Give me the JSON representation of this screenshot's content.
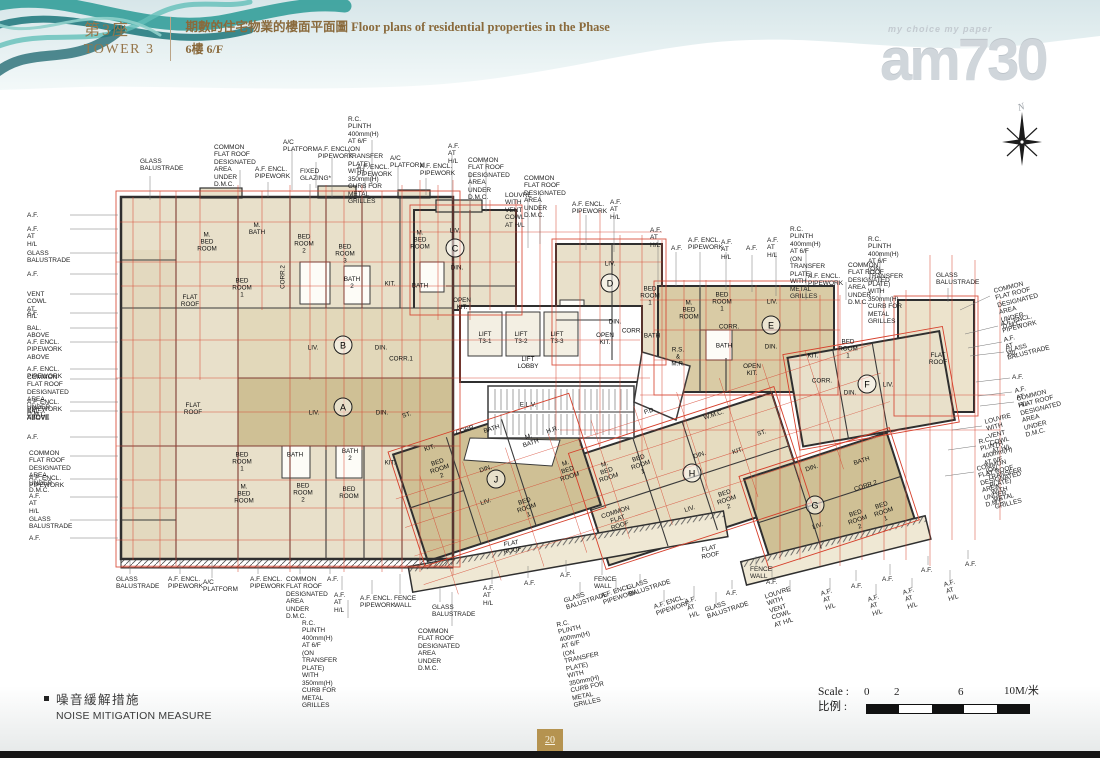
{
  "header": {
    "tower_zh": "第3座",
    "tower_en": "TOWER 3",
    "title_line1": "期數的住宅物業的樓面平面圖 Floor plans of residential properties in the Phase",
    "title_line2": "6樓 6/F"
  },
  "logo": {
    "tagline": "my choice my paper",
    "name": "am730"
  },
  "compass": {
    "label": "N"
  },
  "legend": {
    "zh": "噪音緩解措施",
    "en": "NOISE MITIGATION MEASURE"
  },
  "scale": {
    "label_en": "Scale : ",
    "label_zh": "比例 : ",
    "ticks": [
      "0",
      "2",
      "6",
      "10M/米"
    ]
  },
  "page_number": "20",
  "colors": {
    "accent_gold": "#96764a",
    "plan_red": "#d6402c",
    "beige": "#e8e0ca",
    "tan": "#cfc095",
    "teal": "#2a9a95"
  },
  "plan": {
    "units": [
      {
        "t": "A",
        "x": 343,
        "y": 407
      },
      {
        "t": "B",
        "x": 343,
        "y": 345
      },
      {
        "t": "C",
        "x": 455,
        "y": 248
      },
      {
        "t": "D",
        "x": 610,
        "y": 283
      },
      {
        "t": "E",
        "x": 771,
        "y": 325
      },
      {
        "t": "F",
        "x": 867,
        "y": 384
      },
      {
        "t": "G",
        "x": 815,
        "y": 505
      },
      {
        "t": "H",
        "x": 692,
        "y": 473
      },
      {
        "t": "J",
        "x": 496,
        "y": 479
      }
    ],
    "rooms": [
      {
        "t": "M. BED\nROOM",
        "x": 207,
        "y": 243
      },
      {
        "t": "M. BATH",
        "x": 257,
        "y": 230
      },
      {
        "t": "BED\nROOM 1",
        "x": 242,
        "y": 289
      },
      {
        "t": "BED\nROOM 2",
        "x": 304,
        "y": 245
      },
      {
        "t": "BED\nROOM 3",
        "x": 345,
        "y": 255
      },
      {
        "t": "BATH 2",
        "x": 352,
        "y": 284
      },
      {
        "t": "CORR.2",
        "x": 284,
        "y": 277,
        "rot": -90
      },
      {
        "t": "KIT.",
        "x": 390,
        "y": 285
      },
      {
        "t": "BATH",
        "x": 420,
        "y": 287
      },
      {
        "t": "FLAT ROOF",
        "x": 190,
        "y": 302
      },
      {
        "t": "LIV.",
        "x": 313,
        "y": 349
      },
      {
        "t": "DIN.",
        "x": 381,
        "y": 349
      },
      {
        "t": "CORR.1",
        "x": 401,
        "y": 360
      },
      {
        "t": "FLAT ROOF",
        "x": 193,
        "y": 410
      },
      {
        "t": "LIV.",
        "x": 314,
        "y": 414
      },
      {
        "t": "DIN.",
        "x": 382,
        "y": 414
      },
      {
        "t": "BED\nROOM 1",
        "x": 242,
        "y": 463
      },
      {
        "t": "BATH",
        "x": 295,
        "y": 456
      },
      {
        "t": "BATH 2",
        "x": 350,
        "y": 456
      },
      {
        "t": "KIT.",
        "x": 390,
        "y": 464
      },
      {
        "t": "M. BED\nROOM",
        "x": 244,
        "y": 495
      },
      {
        "t": "BED\nROOM 2",
        "x": 303,
        "y": 494
      },
      {
        "t": "BED\nROOM",
        "x": 349,
        "y": 494
      },
      {
        "t": "M. BED\nROOM",
        "x": 420,
        "y": 241
      },
      {
        "t": "LIV.",
        "x": 455,
        "y": 232
      },
      {
        "t": "DIN.",
        "x": 457,
        "y": 269
      },
      {
        "t": "OPEN KIT.",
        "x": 462,
        "y": 305
      },
      {
        "t": "LIFT\nT3-1",
        "x": 485,
        "y": 339
      },
      {
        "t": "LIFT\nT3-2",
        "x": 521,
        "y": 339
      },
      {
        "t": "LIFT\nT3-3",
        "x": 557,
        "y": 339
      },
      {
        "t": "LIFT LOBBY",
        "x": 528,
        "y": 364
      },
      {
        "t": "LIV.",
        "x": 610,
        "y": 265
      },
      {
        "t": "DIN.",
        "x": 615,
        "y": 323
      },
      {
        "t": "OPEN KIT.",
        "x": 605,
        "y": 340
      },
      {
        "t": "CORR.",
        "x": 632,
        "y": 332
      },
      {
        "t": "BED\nROOM 1",
        "x": 650,
        "y": 297
      },
      {
        "t": "BATH",
        "x": 652,
        "y": 337
      },
      {
        "t": "M. BED\nROOM",
        "x": 689,
        "y": 311
      },
      {
        "t": "BED\nROOM 1",
        "x": 722,
        "y": 303
      },
      {
        "t": "LIV.",
        "x": 772,
        "y": 303
      },
      {
        "t": "CORR.",
        "x": 729,
        "y": 328
      },
      {
        "t": "BATH",
        "x": 724,
        "y": 347
      },
      {
        "t": "DIN.",
        "x": 771,
        "y": 348
      },
      {
        "t": "OPEN KIT.",
        "x": 752,
        "y": 371
      },
      {
        "t": "KIT.",
        "x": 813,
        "y": 357
      },
      {
        "t": "BED\nROOM 1",
        "x": 848,
        "y": 350
      },
      {
        "t": "CORR.",
        "x": 822,
        "y": 382
      },
      {
        "t": "DIN.",
        "x": 850,
        "y": 394
      },
      {
        "t": "LIV.",
        "x": 888,
        "y": 386
      },
      {
        "t": "FLAT ROOF",
        "x": 938,
        "y": 360
      },
      {
        "t": "ST.",
        "x": 407,
        "y": 416,
        "rot": -18
      },
      {
        "t": "KIT.",
        "x": 430,
        "y": 449,
        "rot": -18
      },
      {
        "t": "BED\nROOM 2",
        "x": 440,
        "y": 470,
        "rot": -18
      },
      {
        "t": "CORR.",
        "x": 466,
        "y": 431,
        "rot": -18
      },
      {
        "t": "BATH",
        "x": 492,
        "y": 430,
        "rot": -18
      },
      {
        "t": "M. BATH",
        "x": 530,
        "y": 441,
        "rot": -18
      },
      {
        "t": "DIN.",
        "x": 486,
        "y": 470,
        "rot": -18
      },
      {
        "t": "LIV.",
        "x": 486,
        "y": 503,
        "rot": -18
      },
      {
        "t": "BED\nROOM 1",
        "x": 527,
        "y": 509,
        "rot": -18
      },
      {
        "t": "M. BED\nROOM",
        "x": 568,
        "y": 471,
        "rot": -18
      },
      {
        "t": "E.L.V.",
        "x": 528,
        "y": 406
      },
      {
        "t": "H.R.",
        "x": 553,
        "y": 431,
        "rot": -18
      },
      {
        "t": "P.D.",
        "x": 650,
        "y": 412,
        "rot": -18
      },
      {
        "t": "W.M.C.",
        "x": 714,
        "y": 416,
        "rot": -18
      },
      {
        "t": "R.S. & M.R.",
        "x": 678,
        "y": 358
      },
      {
        "t": "M. BED\nROOM",
        "x": 607,
        "y": 472,
        "rot": -18
      },
      {
        "t": "BED\nROOM 1",
        "x": 641,
        "y": 466,
        "rot": -18
      },
      {
        "t": "DIN.",
        "x": 700,
        "y": 456,
        "rot": -18
      },
      {
        "t": "KIT.",
        "x": 738,
        "y": 452,
        "rot": -18
      },
      {
        "t": "ST.",
        "x": 762,
        "y": 434,
        "rot": -18
      },
      {
        "t": "LIV.",
        "x": 690,
        "y": 510,
        "rot": -18
      },
      {
        "t": "BED\nROOM 2",
        "x": 727,
        "y": 501,
        "rot": -18
      },
      {
        "t": "COMMON\nFLAT ROOF",
        "x": 618,
        "y": 520,
        "rot": -18
      },
      {
        "t": "FLAT ROOF",
        "x": 710,
        "y": 553,
        "rot": -12
      },
      {
        "t": "FLAT ROOF",
        "x": 512,
        "y": 548,
        "rot": -10
      },
      {
        "t": "DIN.",
        "x": 812,
        "y": 469,
        "rot": -18
      },
      {
        "t": "BATH",
        "x": 862,
        "y": 462,
        "rot": -18
      },
      {
        "t": "CORR.2",
        "x": 866,
        "y": 487,
        "rot": -18
      },
      {
        "t": "LIV.",
        "x": 818,
        "y": 527,
        "rot": -18
      },
      {
        "t": "BED\nROOM 2",
        "x": 858,
        "y": 521,
        "rot": -18
      },
      {
        "t": "BED\nROOM 1",
        "x": 884,
        "y": 513,
        "rot": -18
      }
    ],
    "callouts": [
      {
        "t": "GLASS\nBALUSTRADE",
        "x": 140,
        "y": 158
      },
      {
        "t": "COMMON FLAT ROOF\nDESIGNATED AREA UNDER D.M.C.",
        "x": 214,
        "y": 144
      },
      {
        "t": "A.F. ENCL.\nPIPEWORK",
        "x": 255,
        "y": 166
      },
      {
        "t": "A/C PLATFORM",
        "x": 283,
        "y": 139
      },
      {
        "t": "A.F. ENCL.\nPIPEWORK",
        "x": 318,
        "y": 146
      },
      {
        "t": "FIXED\nGLAZING*",
        "x": 300,
        "y": 168
      },
      {
        "t": "R.C. PLINTH 400mm(H) AT 6/F\n(ON TRANSFER PLATE) WITH\n350mm(H) CURB FOR METAL GRILLES",
        "x": 348,
        "y": 116
      },
      {
        "t": "A.F. ENCL.\nPIPEWORK",
        "x": 357,
        "y": 164
      },
      {
        "t": "A/C PLATFORM",
        "x": 390,
        "y": 155
      },
      {
        "t": "A.F. ENCL.\nPIPEWORK",
        "x": 420,
        "y": 163
      },
      {
        "t": "A.F.\nAT H/L",
        "x": 448,
        "y": 143
      },
      {
        "t": "COMMON FLAT ROOF\nDESIGNATED AREA UNDER D.M.C.",
        "x": 468,
        "y": 157
      },
      {
        "t": "COMMON FLAT ROOF\nDESIGNATED AREA UNDER D.M.C.",
        "x": 524,
        "y": 175
      },
      {
        "t": "LOUVRE WITH\nVENT COWL\nAT H/L",
        "x": 505,
        "y": 192
      },
      {
        "t": "A.F. ENCL.\nPIPEWORK",
        "x": 572,
        "y": 201
      },
      {
        "t": "A.F.\nAT H/L",
        "x": 610,
        "y": 199
      },
      {
        "t": "A.F.\nAT H/L",
        "x": 650,
        "y": 227
      },
      {
        "t": "A.F.",
        "x": 671,
        "y": 245
      },
      {
        "t": "A.F. ENCL.\nPIPEWORK",
        "x": 688,
        "y": 237
      },
      {
        "t": "A.F.\nAT H/L",
        "x": 721,
        "y": 239
      },
      {
        "t": "A.F.",
        "x": 746,
        "y": 245
      },
      {
        "t": "A.F.\nAT H/L",
        "x": 767,
        "y": 237
      },
      {
        "t": "R.C. PLINTH 400mm(H) AT 6/F\n(ON TRANSFER PLATE)\nWITH METAL GRILLES",
        "x": 790,
        "y": 226
      },
      {
        "t": "R.C. PLINTH 400mm(H) AT 6/F\n(ON TRANSFER PLATE) WITH\n350mm(H) CURB FOR METAL GRILLES",
        "x": 868,
        "y": 236
      },
      {
        "t": "A.F. ENCL.\nPIPEWORK",
        "x": 808,
        "y": 273
      },
      {
        "t": "COMMON FLAT ROOF\nDESIGNATED AREA\nUNDER D.M.C.",
        "x": 848,
        "y": 262
      },
      {
        "t": "GLASS\nBALUSTRADE",
        "x": 936,
        "y": 272
      },
      {
        "t": "COMMON FLAT ROOF\nDESIGNATED AREA UNDER\nD.M.C.",
        "x": 993,
        "y": 288,
        "rot": -14
      },
      {
        "t": "A.F. ENCL. PIPEWORK",
        "x": 1000,
        "y": 321,
        "rot": -14
      },
      {
        "t": "A.F. AT H/L",
        "x": 1003,
        "y": 337,
        "rot": -14
      },
      {
        "t": "GLASS BALUSTRADE",
        "x": 1005,
        "y": 348,
        "rot": -14
      },
      {
        "t": "A.F.",
        "x": 1012,
        "y": 374
      },
      {
        "t": "A.F. AT H/L",
        "x": 1014,
        "y": 388,
        "rot": -14
      },
      {
        "t": "COMMON FLAT ROOF\nDESIGNATED AREA UNDER\nD.M.C.",
        "x": 1016,
        "y": 396,
        "rot": -14
      },
      {
        "t": "LOUVRE WITH\nVENT COWL AT H/L",
        "x": 984,
        "y": 419,
        "rot": -14
      },
      {
        "t": "R.C. PLINTH 400mm(H) AT 6/F\n(ON TRANSFER PLATE)\nWITH METAL GRILLES",
        "x": 978,
        "y": 439,
        "rot": -14
      },
      {
        "t": "COMMON FLAT ROOF\nDESIGNATED AREA\nUNDER D.M.C.",
        "x": 976,
        "y": 466,
        "rot": -14
      },
      {
        "t": "A.F.",
        "x": 27,
        "y": 212
      },
      {
        "t": "A.F. AT H/L",
        "x": 27,
        "y": 226
      },
      {
        "t": "GLASS BALUSTRADE",
        "x": 27,
        "y": 250
      },
      {
        "t": "A.F.",
        "x": 27,
        "y": 271
      },
      {
        "t": "VENT COWL AT H/L",
        "x": 27,
        "y": 291
      },
      {
        "t": "A.F.",
        "x": 27,
        "y": 310
      },
      {
        "t": "BAL. ABOVE",
        "x": 27,
        "y": 325
      },
      {
        "t": "A.F. ENCL. PIPEWORK ABOVE",
        "x": 27,
        "y": 339
      },
      {
        "t": "A.F. ENCL.  PIPEWORK",
        "x": 27,
        "y": 366
      },
      {
        "t": "COMMON FLAT ROOF\nDESIGNATED AREA UNDER D.M.C.",
        "x": 27,
        "y": 374
      },
      {
        "t": "A.F. ENCL. PIPEWORK ABOVE",
        "x": 27,
        "y": 399
      },
      {
        "t": "BAL. ABOVE",
        "x": 27,
        "y": 408
      },
      {
        "t": "A.F.",
        "x": 27,
        "y": 434
      },
      {
        "t": "COMMON FLAT ROOF\nDESIGNATED AREA UNDER D.M.C.",
        "x": 29,
        "y": 450
      },
      {
        "t": "A.F. ENCL.  PIPEWORK",
        "x": 29,
        "y": 475
      },
      {
        "t": "A.F.  AT H/L",
        "x": 29,
        "y": 493
      },
      {
        "t": "GLASS BALUSTRADE",
        "x": 29,
        "y": 516
      },
      {
        "t": "A.F.",
        "x": 29,
        "y": 535
      },
      {
        "t": "GLASS\nBALUSTRADE",
        "x": 116,
        "y": 576
      },
      {
        "t": "A.F. ENCL.\nPIPEWORK",
        "x": 168,
        "y": 576
      },
      {
        "t": "A/C PLATFORM",
        "x": 203,
        "y": 579
      },
      {
        "t": "A.F. ENCL.\nPIPEWORK",
        "x": 250,
        "y": 576
      },
      {
        "t": "COMMON\nFLAT ROOF\nDESIGNATED AREA\nUNDER D.M.C.",
        "x": 286,
        "y": 576
      },
      {
        "t": "A.F.",
        "x": 327,
        "y": 576
      },
      {
        "t": "A.F.\nAT H/L",
        "x": 334,
        "y": 592
      },
      {
        "t": "A.F. ENCL.\nPIPEWORK",
        "x": 360,
        "y": 595
      },
      {
        "t": "FENCE\nWALL",
        "x": 394,
        "y": 595
      },
      {
        "t": "R.C. PLINTH 400mm(H) AT 6/F\n(ON TRANSFER PLATE) WITH\n350mm(H) CURB FOR METAL GRILLES",
        "x": 302,
        "y": 620
      },
      {
        "t": "GLASS\nBALUSTRADE",
        "x": 432,
        "y": 604
      },
      {
        "t": "COMMON FLAT ROOF\nDESIGNATED AREA\nUNDER D.M.C.",
        "x": 418,
        "y": 628
      },
      {
        "t": "A.F.\nAT H/L",
        "x": 483,
        "y": 585
      },
      {
        "t": "A.F.",
        "x": 524,
        "y": 580
      },
      {
        "t": "A.F.",
        "x": 560,
        "y": 572
      },
      {
        "t": "FENCE\nWALL",
        "x": 594,
        "y": 576
      },
      {
        "t": "GLASS\nBALUSTRADE",
        "x": 563,
        "y": 598,
        "rot": -18
      },
      {
        "t": "A.F. ENCL.\nPIPEWORK",
        "x": 600,
        "y": 593,
        "rot": -18
      },
      {
        "t": "GLASS\nBALUSTRADE",
        "x": 626,
        "y": 585,
        "rot": -18
      },
      {
        "t": "R.C. PLINTH 400mm(H) AT 6/F\n(ON TRANSFER PLATE) WITH\n350mm(H) CURB FOR METAL GRILLES",
        "x": 556,
        "y": 622,
        "rot": -12
      },
      {
        "t": "A.F. ENCL.\nPIPEWORK",
        "x": 653,
        "y": 604,
        "rot": -18
      },
      {
        "t": "A.F.\nAT H/L",
        "x": 684,
        "y": 599,
        "rot": -18
      },
      {
        "t": "GLASS\nBALUSTRADE",
        "x": 704,
        "y": 607,
        "rot": -18
      },
      {
        "t": "A.F.",
        "x": 726,
        "y": 590
      },
      {
        "t": "FENCE\nWALL",
        "x": 750,
        "y": 566
      },
      {
        "t": "A.F.",
        "x": 766,
        "y": 579
      },
      {
        "t": "LOUVRE WITH\nVENT COWL\nAT H/L",
        "x": 764,
        "y": 594,
        "rot": -18
      },
      {
        "t": "A.F.\nAT H/L",
        "x": 820,
        "y": 591,
        "rot": -18
      },
      {
        "t": "A.F.",
        "x": 851,
        "y": 583
      },
      {
        "t": "A.F.\nAT H/L",
        "x": 867,
        "y": 597,
        "rot": -18
      },
      {
        "t": "A.F.",
        "x": 882,
        "y": 576
      },
      {
        "t": "A.F.\nAT H/L",
        "x": 902,
        "y": 590,
        "rot": -18
      },
      {
        "t": "A.F.",
        "x": 921,
        "y": 567
      },
      {
        "t": "A.F.\nAT H/L",
        "x": 943,
        "y": 582,
        "rot": -18
      },
      {
        "t": "A.F.",
        "x": 965,
        "y": 561
      }
    ]
  }
}
